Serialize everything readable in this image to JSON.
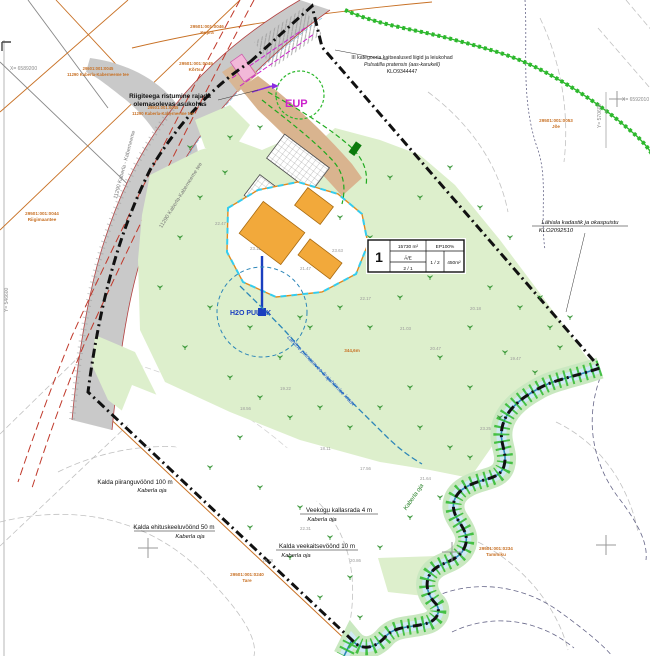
{
  "map_type": "detailplaneeringu põhijoonis (site plan map)",
  "colors": {
    "site_green": "#ddefcc",
    "road_gray": "#c9c9c9",
    "access_tan": "#d9b48f",
    "building_orange": "#f2a93b",
    "boundary_black": "#111111",
    "cadastral_orange": "#c87125",
    "stream_green": "#2db82d",
    "water_blue": "#2d86b8",
    "water_band": "#cfe9f5",
    "magenta": "#cc22cc",
    "red_line": "#c0392b",
    "contour_gray": "#bbbbbb",
    "label_blue": "#2255cc"
  },
  "plot_table": {
    "number": "1",
    "area": "15730 m²",
    "coverage": "EP100%",
    "use": "Ä/E",
    "floors": "2 / 1",
    "buildings": "1 / 2",
    "building_area": "450m²"
  },
  "labels": {
    "eup": "EUP",
    "species_line1": "III kategooria kaitsealused liigid ja leiukohad",
    "species_line2": "Pulsatilla pratensis (aas-karukell)",
    "species_line3": "KLO9344447",
    "crossing_line1": "Riigiteega ristumine rajada",
    "crossing_line2": "olemasolevas asukohas",
    "habitat_line1": "Lähiala kadastik ja okaspuistu",
    "habitat_line2": "KLO2092510",
    "zone100_line1": "Kalda piiranguvöönd 100 m",
    "zone100_line2": "Kaberla oja",
    "zone50_line1": "Kalda ehituskeeluvöönd 50 m",
    "zone50_line2": "Kaberla oja",
    "kallasrada_line1": "Veekogu kallasrada 4 m",
    "kallasrada_line2": "Kaberla oja",
    "zone10_line1": "Kalda veekaitsevöönd 10 m",
    "zone10_line2": "Kaberla oja",
    "drain": "Lahtine pinnasevee ärajuhtimise kraav",
    "drain_len": "344,6m",
    "well": "H2O PUURK",
    "stream_name": "Kaberla oja",
    "road_name_1": "11290 Kaberla - Kaberneeme",
    "road_name_2": "11290 Kaberla-Kaberneeme tee",
    "coord_x1": "X= 6589200",
    "coord_y1": "Y= 570600",
    "coord_x2": "X= 6592010",
    "coord_y2": "Y= 546600"
  },
  "cadastral": [
    {
      "code": "29501:001:0046",
      "name": "Kupra"
    },
    {
      "code": "29501:001:0049",
      "name": "Kõrtsu"
    },
    {
      "code": "29501:001:0045",
      "name": "11290 Kaberla-Kaberneeme tee"
    },
    {
      "code": "29501:001:0045",
      "name": "11290 Kaberla-Kaberneeme tee"
    },
    {
      "code": "29501:001:0044",
      "name": "Riigimaantee"
    },
    {
      "code": "29501:001:0240",
      "name": "Tare"
    },
    {
      "code": "29501:001:0234",
      "name": "Tammiku"
    },
    {
      "code": "29501:001:0053",
      "name": "Jõe"
    }
  ],
  "elevations": [
    "22.47",
    "23.11",
    "21.47",
    "23.63",
    "22.17",
    "21.03",
    "20.47",
    "20.18",
    "19.47",
    "19.22",
    "18.56",
    "18.11",
    "17.56",
    "21.64",
    "22.31",
    "20.86",
    "19.78",
    "23.25"
  ]
}
